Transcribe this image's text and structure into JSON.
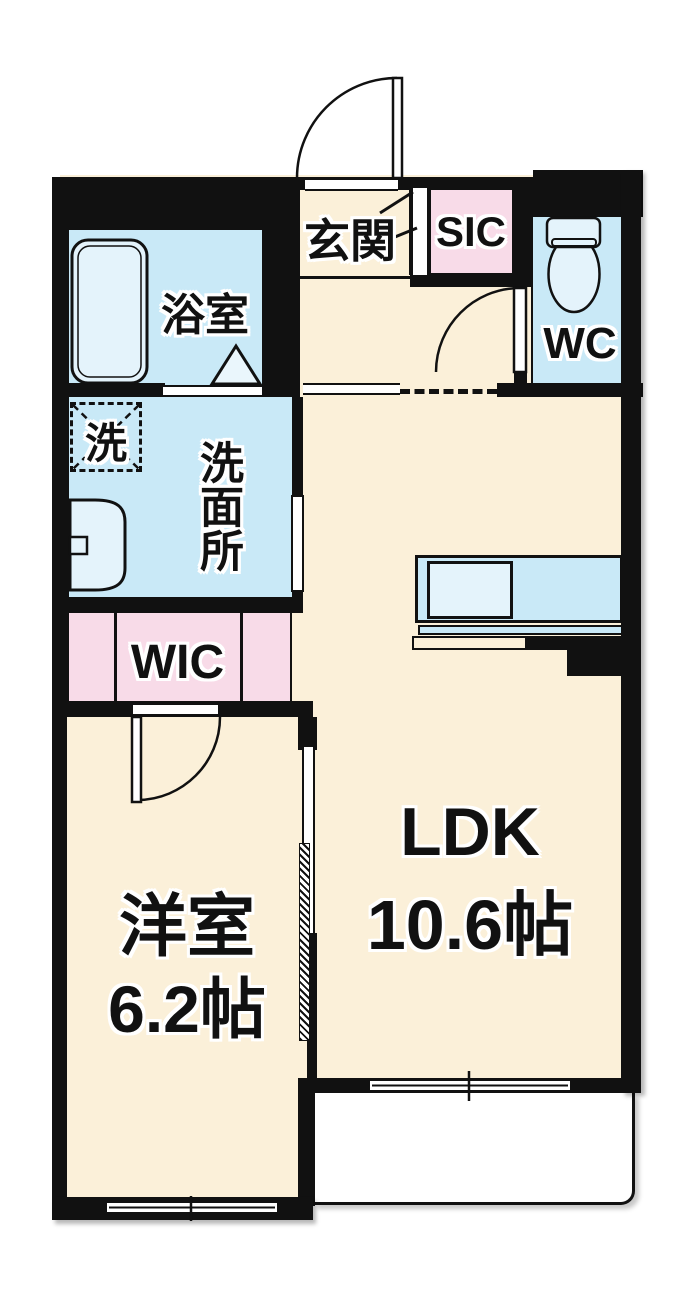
{
  "title": "1LDK floor plan",
  "rooms": {
    "genkan": {
      "label": "玄関"
    },
    "sic": {
      "label": "SIC"
    },
    "wc": {
      "label": "WC"
    },
    "bathroom": {
      "label": "浴室"
    },
    "washer": {
      "label": "洗"
    },
    "washroom": {
      "label": "洗面所"
    },
    "wic": {
      "label": "WIC"
    },
    "bedroom": {
      "label": "洋室",
      "size": "6.2帖"
    },
    "ldk": {
      "label": "LDK",
      "size": "10.6帖"
    }
  },
  "colors": {
    "floor": "#FBF0D9",
    "wet_area": "#C9E9F7",
    "fixture": "#E4F3FB",
    "closet": "#F8DBE8",
    "wall": "#111111",
    "balcony": "#FFFFFF"
  }
}
